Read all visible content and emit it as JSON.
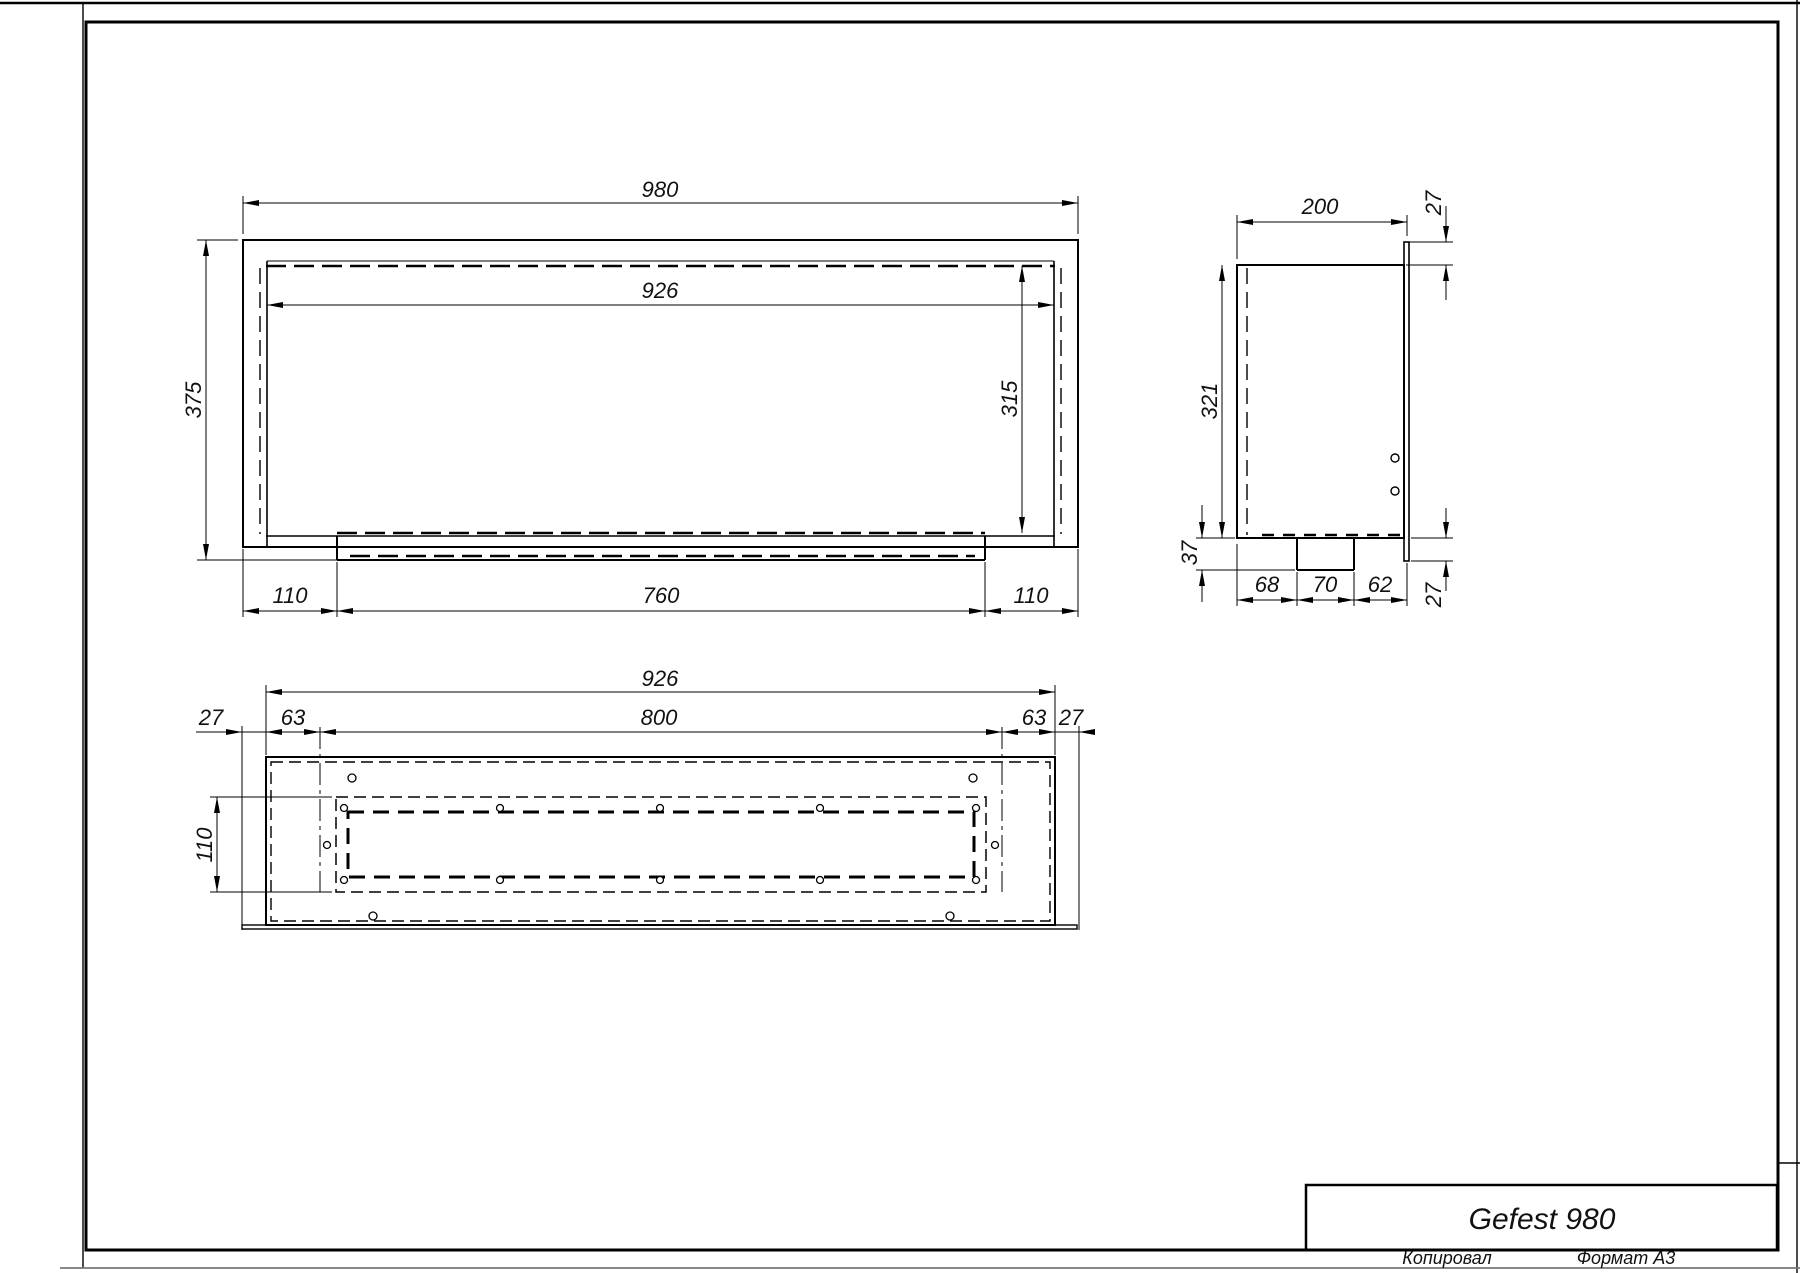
{
  "drawing_title": "Gefest 980",
  "sheet": {
    "copy_label": "Копировал",
    "format_label": "Формат А3"
  },
  "title_block": {
    "model": "Gefest 980"
  },
  "views": {
    "front": {
      "dims": {
        "overall_width": "980",
        "opening_width": "926",
        "overall_height": "375",
        "opening_height": "315",
        "left_offset": "110",
        "burner_width": "760",
        "right_offset": "110"
      }
    },
    "side": {
      "dims": {
        "depth": "200",
        "flange_top_offset": "27",
        "inner_height": "321",
        "outlet_height": "37",
        "rear_offset": "68",
        "outlet_width": "70",
        "front_offset": "62",
        "flange_bottom_offset": "27"
      }
    },
    "bottom": {
      "dims": {
        "opening_width": "926",
        "slot_width": "800",
        "left_frame_offset": "27",
        "left_inset": "63",
        "right_inset": "63",
        "right_frame_offset": "27",
        "slot_height": "110"
      }
    }
  }
}
